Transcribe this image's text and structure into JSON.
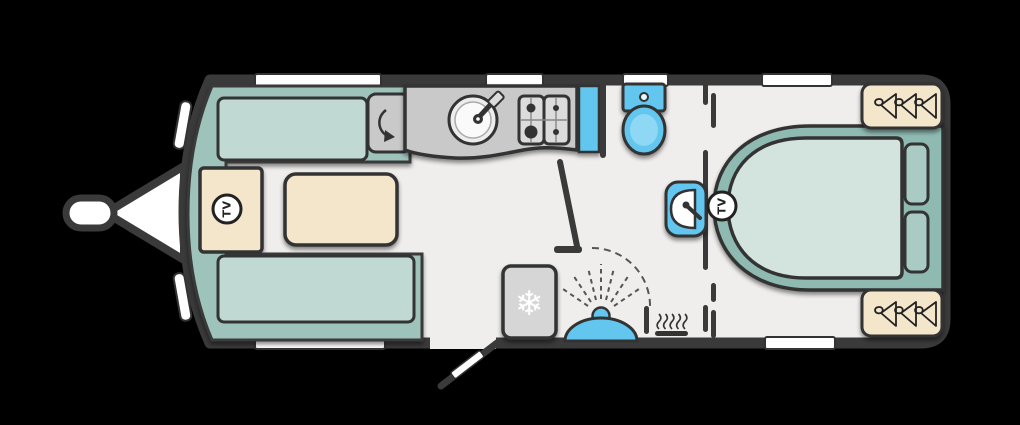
{
  "floorplan": {
    "kind": "caravan-floorplan",
    "labels": {
      "front_tv": "TV",
      "bedroom_tv": "TV"
    },
    "icons": {
      "snowflake_glyph": "❄",
      "names": [
        "tv-point-icon",
        "snowflake-icon",
        "hanger-icon",
        "heater-icon",
        "shower-head-icon",
        "door-swing-arc-icon",
        "tap-icon",
        "corner-swing-arrow-icon"
      ]
    },
    "colors": {
      "outline": "#3a3a3a",
      "floor": "#efeeec",
      "seat_base": "#9dc3bb",
      "cushion": "#c0dad3",
      "bed_surround": "#8fbab2",
      "mattress": "#d3e4df",
      "pillow": "#a9cbc4",
      "wood_beige": "#f4e6cb",
      "kitchen_grey": "#c9c9c9",
      "fridge_grey": "#d6d6d6",
      "fixture_blue": "#63c6ef",
      "window_white": "#ffffff"
    }
  }
}
